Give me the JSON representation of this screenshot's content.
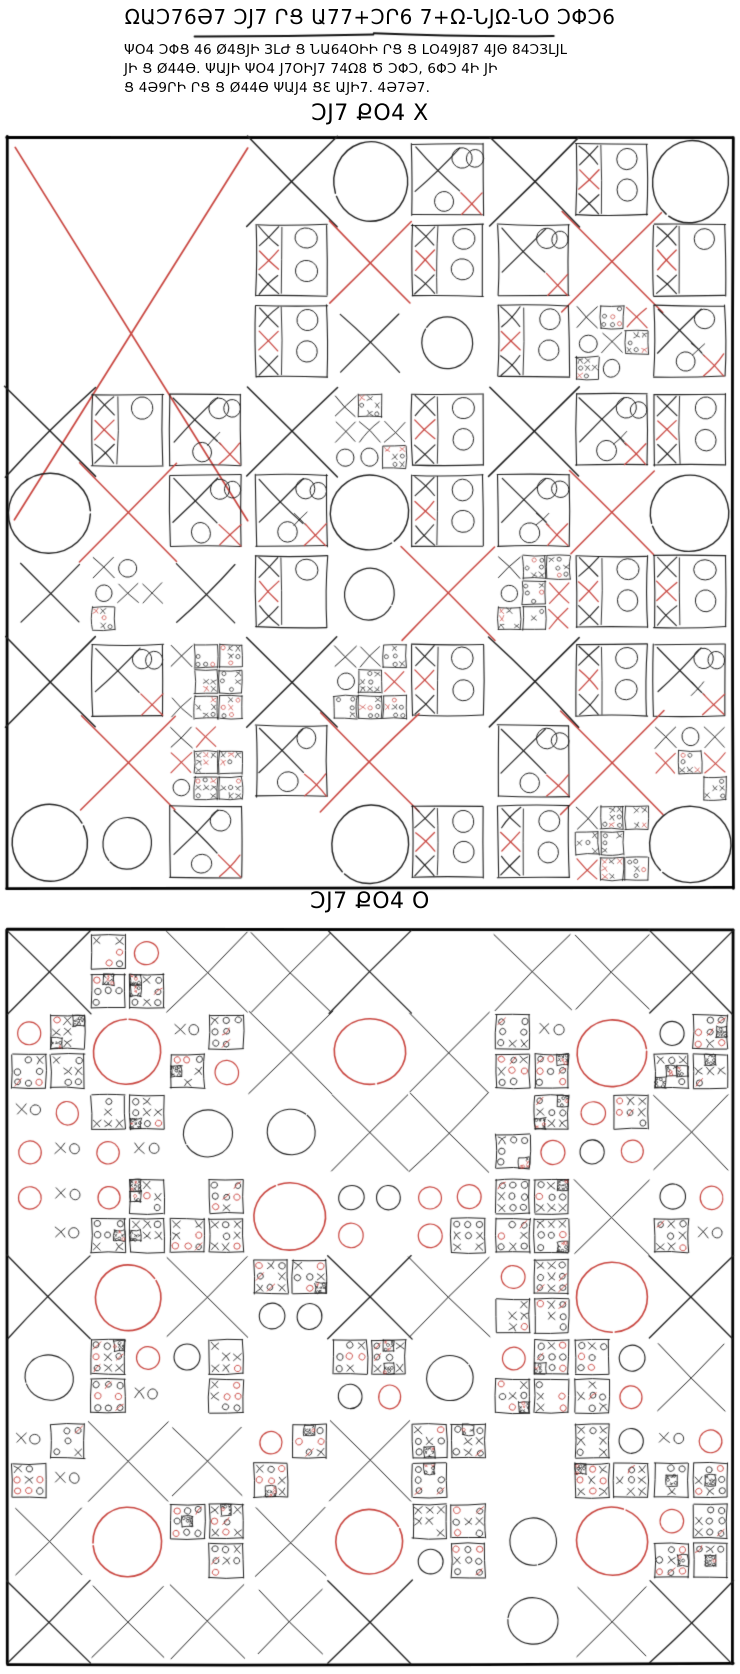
{
  "page": {
    "width": 740,
    "height": 1674,
    "background": "#ffffff"
  },
  "palette": {
    "ink": "#1e1e1e",
    "accent": "#c8453f",
    "frame": "#000000",
    "background": "#ffffff"
  },
  "header": {
    "title": "ΩԱƆ76Ә7 ƆЈ7 ՐՑ Ա77+ƆՐ6 7+Ω-ՆЈΩ-ՆՕ ƆΦƆ6",
    "underline": {
      "x1": 195,
      "x2": 553,
      "y": 35
    },
    "subtitle_lines": [
      "ΨO4 ƆΦՑ 46 Ø4ՑЈԻ ЗԼԺ Ց ՆԱ64ՕԻԻ ՐՑ Ց ԼՕ49Ј87 4ЈΘ 84ƆЗԼЈԼ",
      "ЈԻ Ց Ø44Ө. ΨԱЈԻ ΨO4 Ј7OԻЈ7 74Ω8 Ծ ƆΦƆ, 6ΦƆ 4Ի ЈԻ",
      "Ց 4Ә9ՐԻ ՐՑ Ց Ø44Ө ΨԱЈ4 ՑƐ ԱЈԻ7. 4Ә7Ә7."
    ]
  },
  "maps": [
    {
      "id": "map-x",
      "label": "ƆЈ7 ՔO4 X",
      "player_symbol": "X",
      "mark_color": "#c8453f",
      "grid": [
        3,
        3
      ],
      "frame": {
        "x": 7,
        "y": 137,
        "w": 726,
        "h": 751
      },
      "big_red_move": {
        "region": "top-left",
        "x": 15,
        "y": 148,
        "w": 233,
        "h": 372
      },
      "seed": 20832
    },
    {
      "id": "map-o",
      "label": "ƆЈ7 ՔO4 O",
      "player_symbol": "O",
      "mark_color": "#c8453f",
      "grid": [
        3,
        3
      ],
      "frame": {
        "x": 7,
        "y": 930,
        "w": 726,
        "h": 734
      },
      "red_circle_rule": "center-subcell (top-left subcell in center region)",
      "seed": 70832
    }
  ]
}
